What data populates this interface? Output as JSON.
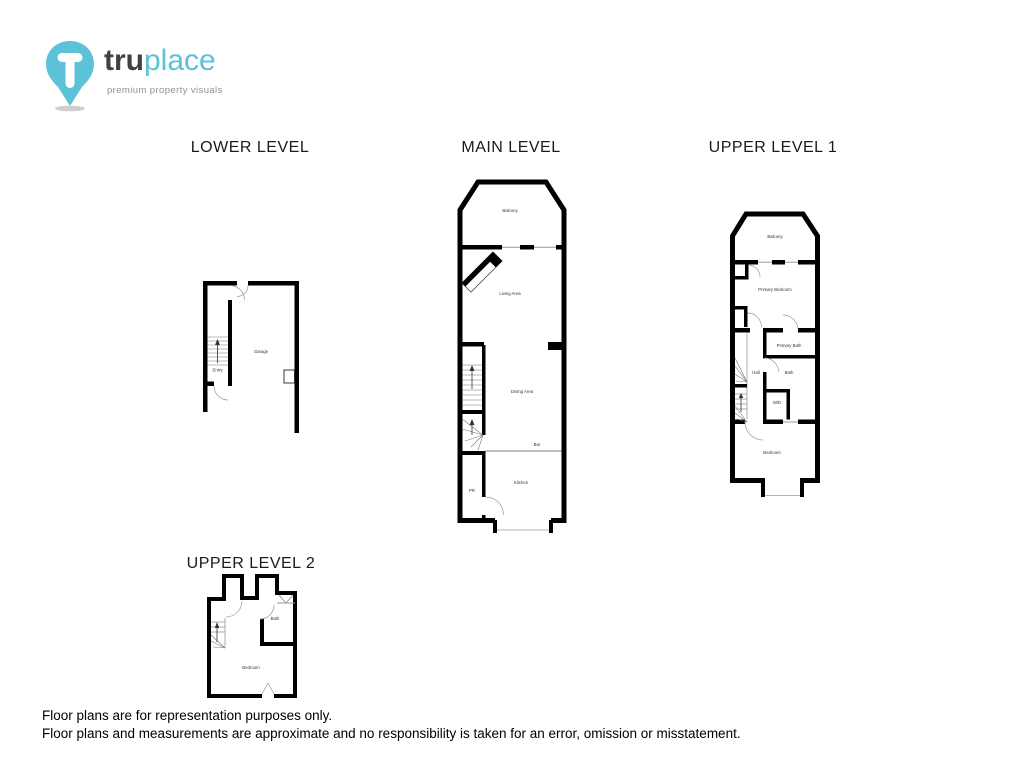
{
  "logo": {
    "brand_bold": "tru",
    "brand_light": "place",
    "tagline": "premium property visuals"
  },
  "floors": {
    "lower": {
      "title": "LOWER LEVEL",
      "rooms": {
        "entry": "Entry",
        "garage": "Garage"
      }
    },
    "main": {
      "title": "MAIN LEVEL",
      "rooms": {
        "balcony": "Balcony",
        "living_area": "Living Area",
        "dining_area": "Dining Area",
        "bar": "Bar",
        "kitchen": "Kitchen",
        "powder_room": "PR"
      }
    },
    "upper1": {
      "title": "UPPER LEVEL 1",
      "rooms": {
        "balcony": "Balcony",
        "primary_bedroom": "Primary Bedroom",
        "primary_bath": "Primary Bath",
        "hall": "Hall",
        "bath": "Bath",
        "washer_dryer": "W/D",
        "bedroom": "Bedroom"
      }
    },
    "upper2": {
      "title": "UPPER LEVEL 2",
      "rooms": {
        "bath": "Bath",
        "bedroom": "Bedroom"
      }
    }
  },
  "disclaimer": {
    "line1": "Floor plans are for representation purposes only.",
    "line2": "Floor plans and measurements are approximate and no responsibility is taken for an error, omission or misstatement."
  },
  "colors": {
    "brand_blue": "#5bc2d8",
    "brand_dark": "#3d4247",
    "wall": "#000000",
    "label": "#333333"
  }
}
